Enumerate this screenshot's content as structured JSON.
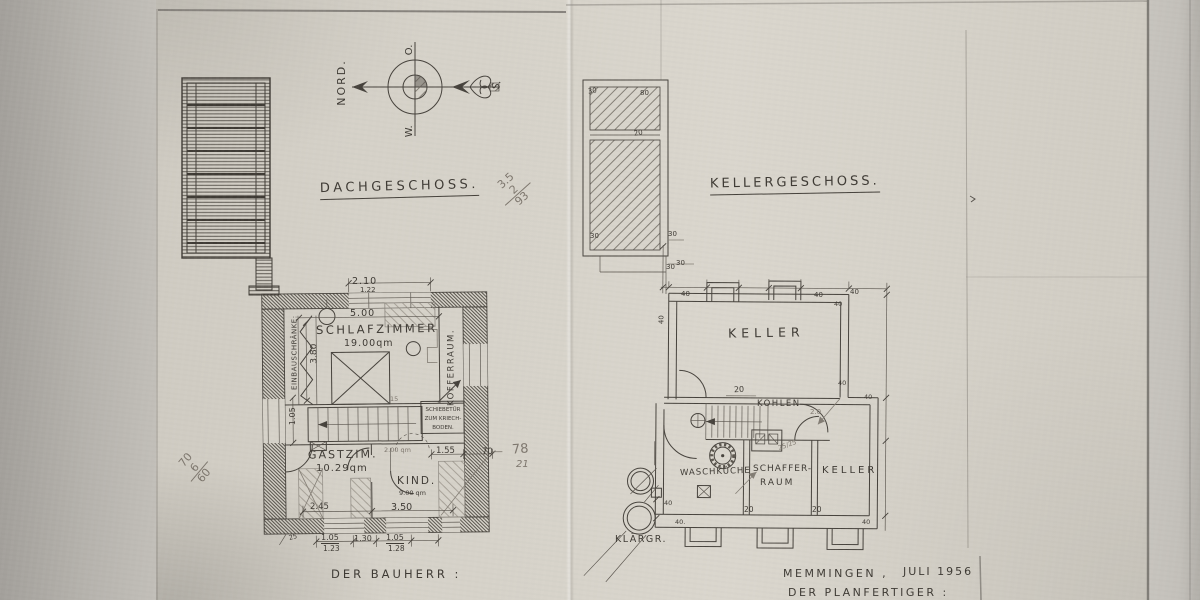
{
  "compass": {
    "north": "NORD.",
    "east": "O.",
    "west": "W.",
    "south": "S."
  },
  "attic": {
    "title": "DACHGESCHOSS.",
    "rooms": {
      "schlafzimmer": "SCHLAFZIMMER",
      "schlafzimmer_area": "19.00qm",
      "einbauschraenke": "EINBAUSCHRÄNKE:",
      "kofferraum": "KOFFERRAUM.",
      "gastzimmer": "GASTZIM.",
      "gastzimmer_area": "10.29qm",
      "kind": "KIND.",
      "kind_area": "9.00 qm",
      "schiebetuer_line1": "SCHIEBETÜR",
      "schiebetuer_line2": "ZUM KRIECH-",
      "schiebetuer_line3": "BODEN."
    },
    "dims": {
      "w210": "2.10",
      "w122": "1.22",
      "w500": "5.00",
      "h380": "3.80",
      "h105": "1.05",
      "n15": "15",
      "pencil_area": "2.00 qm",
      "w155": "1.55",
      "w70": "70",
      "w245": "2.45",
      "w350": "3.50",
      "b25": "25",
      "b105a": "1.05",
      "b123": "1.23",
      "b130": "1.30",
      "b105b": "1.05",
      "b128": "1.28"
    }
  },
  "cellar": {
    "title": "KELLERGESCHOSS.",
    "rooms": {
      "keller_main": "KELLER",
      "kohlen": "KOHLEN",
      "waschkueche": "WASCHKÜCHE",
      "schaffer_line1": "SCHAFFER-",
      "schaffer_line2": "RAUM",
      "keller_small": "KELLER",
      "klaergrube": "KLÄRGR."
    },
    "dims": {
      "t30": "30",
      "t40a": "40",
      "t40b": "40",
      "t40c": "40",
      "l40": "40",
      "r40a": "40",
      "r40b": "40",
      "r40c": "40",
      "c20": "20",
      "k20": "2.0",
      "p2525": "25/25",
      "b40a": "40",
      "b40b": "40.",
      "b20a": "20",
      "b20b": "20",
      "b40c": "40"
    }
  },
  "chimney": {
    "dims": {
      "d30a": "30",
      "d80": "80",
      "d20": "20",
      "d30b": "30",
      "d30c": "30",
      "d30d": "30"
    }
  },
  "pencil_notes": {
    "calc_a1": "3.5",
    "calc_a2": "2",
    "calc_a3": "93",
    "calc_b1": "70",
    "calc_b2": "6",
    "calc_b3": "60",
    "calc_c1": "78",
    "calc_c2": "21"
  },
  "footer": {
    "bauherr": "DER BAUHERR :",
    "city": "MEMMINGEN ,",
    "date": "JULI 1956",
    "planfertiger": "DER PLANFERTIGER :"
  }
}
